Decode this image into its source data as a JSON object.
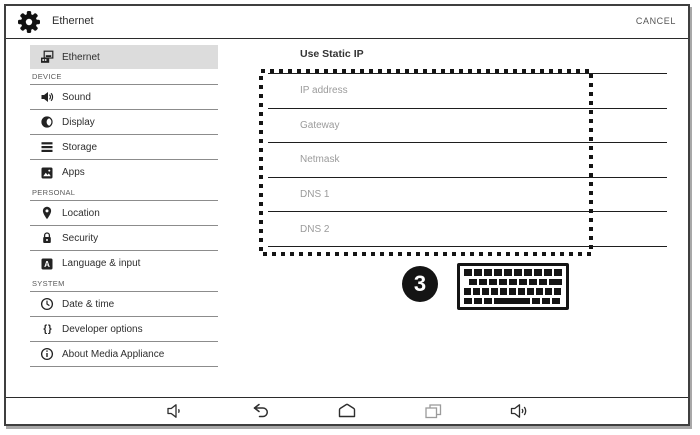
{
  "header": {
    "title": "Ethernet",
    "cancel_label": "CANCEL",
    "icon": "gear-icon"
  },
  "sidebar": {
    "items": [
      {
        "type": "item",
        "label": "Ethernet",
        "icon": "ethernet-icon",
        "selected": true,
        "divider": false
      },
      {
        "type": "section",
        "label": "DEVICE",
        "divider": true
      },
      {
        "type": "item",
        "label": "Sound",
        "icon": "speaker-icon",
        "divider": true
      },
      {
        "type": "item",
        "label": "Display",
        "icon": "contrast-icon",
        "divider": true
      },
      {
        "type": "item",
        "label": "Storage",
        "icon": "storage-bars-icon",
        "divider": true
      },
      {
        "type": "item",
        "label": "Apps",
        "icon": "apps-photo-icon",
        "divider": false
      },
      {
        "type": "section",
        "label": "PERSONAL",
        "divider": true
      },
      {
        "type": "item",
        "label": "Location",
        "icon": "location-pin-icon",
        "divider": true
      },
      {
        "type": "item",
        "label": "Security",
        "icon": "lock-icon",
        "divider": true
      },
      {
        "type": "item",
        "label": "Language & input",
        "icon": "language-a-icon",
        "divider": false
      },
      {
        "type": "section",
        "label": "SYSTEM",
        "divider": true
      },
      {
        "type": "item",
        "label": "Date & time",
        "icon": "clock-icon",
        "divider": true
      },
      {
        "type": "item",
        "label": "Developer options",
        "icon": "braces-icon",
        "divider": true
      },
      {
        "type": "item",
        "label": "About Media Appliance",
        "icon": "info-icon",
        "divider": true
      }
    ]
  },
  "main": {
    "section_title": "Use Static IP",
    "fields": [
      {
        "placeholder": "IP address"
      },
      {
        "placeholder": "Gateway"
      },
      {
        "placeholder": "Netmask"
      },
      {
        "placeholder": "DNS 1"
      },
      {
        "placeholder": "DNS 2"
      }
    ],
    "annotation": {
      "step_number": "3",
      "icon": "keyboard-icon"
    }
  },
  "navbar": {
    "items": [
      {
        "icon": "volume-down-icon"
      },
      {
        "icon": "back-icon"
      },
      {
        "icon": "home-icon"
      },
      {
        "icon": "recents-icon"
      },
      {
        "icon": "volume-up-icon"
      }
    ]
  },
  "colors": {
    "selected_row_bg": "#dcdcdc",
    "line_dark": "#1e1e1e",
    "line_gray": "#8c8c8c",
    "placeholder_gray": "#9b9b9b",
    "annotation_black": "#141414"
  }
}
